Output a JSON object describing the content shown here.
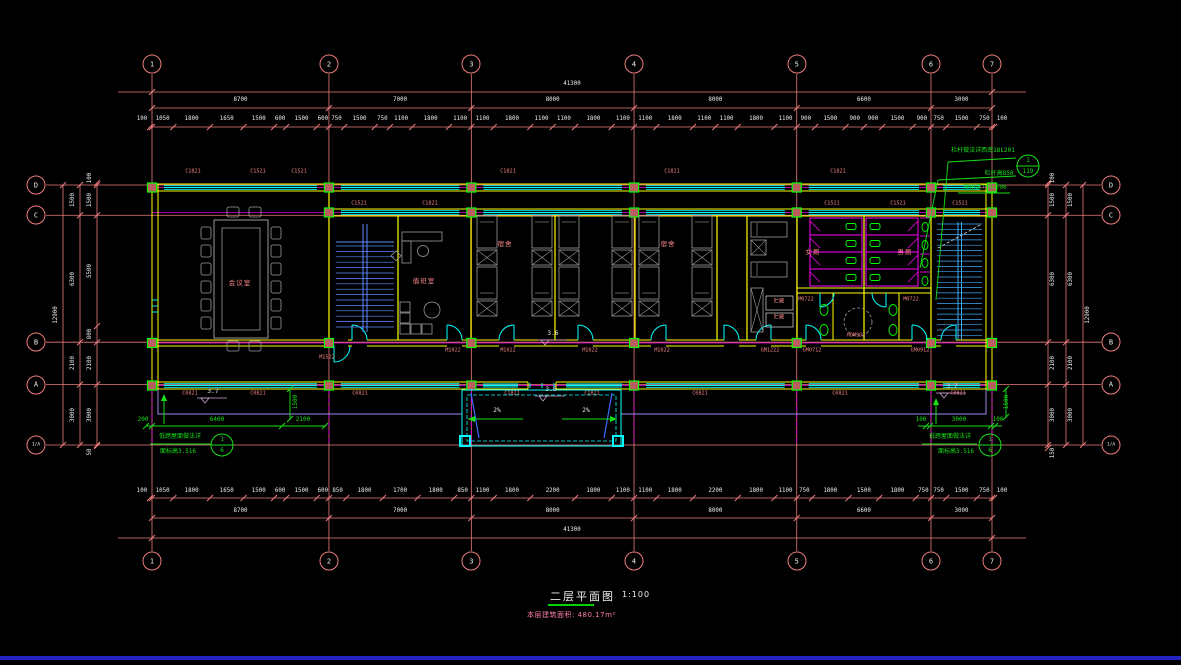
{
  "drawing": {
    "title": "二层平面图",
    "scale": "1:100",
    "area_note": "本层建筑面积: 480.17m²"
  },
  "grid": {
    "cols": [
      {
        "label": "1",
        "mm": 0
      },
      {
        "label": "2",
        "mm": 8700
      },
      {
        "label": "3",
        "mm": 15700
      },
      {
        "label": "4",
        "mm": 23700
      },
      {
        "label": "5",
        "mm": 31700
      },
      {
        "label": "6",
        "mm": 38300
      },
      {
        "label": "7",
        "mm": 41300
      }
    ],
    "rows": [
      {
        "label": "D",
        "mm": 0
      },
      {
        "label": "C",
        "mm": 1500
      },
      {
        "label": "B",
        "mm": 7800
      },
      {
        "label": "A",
        "mm": 9900
      },
      {
        "label": "1/A",
        "mm": 12900
      }
    ]
  },
  "dims": {
    "top": {
      "overall": "41300",
      "spans": [
        "8700",
        "7000",
        "8000",
        "8000",
        "6600",
        "3000"
      ],
      "details": [
        "100",
        "1050",
        "1800",
        "1650",
        "1500",
        "600",
        "1500",
        "600",
        "750",
        "1500",
        "750",
        "1100",
        "1800",
        "1100",
        "1100",
        "1800",
        "1100",
        "1100",
        "1800",
        "1100",
        "1100",
        "1800",
        "1100",
        "1100",
        "1800",
        "1100",
        "900",
        "1500",
        "900",
        "900",
        "1500",
        "900",
        "750",
        "1500",
        "750",
        "100"
      ]
    },
    "bottom": {
      "overall": "41300",
      "spans": [
        "8700",
        "7000",
        "8000",
        "8000",
        "6600",
        "3000"
      ],
      "details": [
        "100",
        "1050",
        "1800",
        "1650",
        "1500",
        "600",
        "1500",
        "600",
        "850",
        "1800",
        "1700",
        "1800",
        "850",
        "1100",
        "1800",
        "2200",
        "1800",
        "1100",
        "1100",
        "1800",
        "2200",
        "1800",
        "1100",
        "750",
        "1800",
        "1500",
        "1800",
        "750",
        "750",
        "1500",
        "750",
        "100"
      ]
    },
    "left": {
      "overall": "12900",
      "spans": [
        "1500",
        "6300",
        "2100",
        "3000"
      ],
      "details": [
        "100",
        "1500",
        "5500",
        "800",
        "2100",
        "3000",
        "50"
      ]
    },
    "right": {
      "overall": "12900",
      "spans": [
        "1500",
        "6300",
        "2100",
        "3000"
      ],
      "details": [
        "100",
        "1500",
        "6300",
        "2100",
        "3000",
        "150"
      ]
    }
  },
  "window_tags": [
    {
      "t": "C1821",
      "x": 193,
      "y": 172
    },
    {
      "t": "C1521",
      "x": 258,
      "y": 172
    },
    {
      "t": "C1521",
      "x": 299,
      "y": 172
    },
    {
      "t": "C1821",
      "x": 508,
      "y": 172
    },
    {
      "t": "C1821",
      "x": 672,
      "y": 172
    },
    {
      "t": "C1821",
      "x": 838,
      "y": 172
    },
    {
      "t": "C1521",
      "x": 359,
      "y": 204
    },
    {
      "t": "C1821",
      "x": 430,
      "y": 204
    },
    {
      "t": "C1521",
      "x": 832,
      "y": 204
    },
    {
      "t": "C1521",
      "x": 898,
      "y": 204
    },
    {
      "t": "C1521",
      "x": 960,
      "y": 204
    },
    {
      "t": "C0821",
      "x": 190,
      "y": 394
    },
    {
      "t": "C0821",
      "x": 258,
      "y": 394
    },
    {
      "t": "C0821",
      "x": 360,
      "y": 394
    },
    {
      "t": "C1821",
      "x": 512,
      "y": 394
    },
    {
      "t": "C1821",
      "x": 592,
      "y": 394
    },
    {
      "t": "C0821",
      "x": 700,
      "y": 394
    },
    {
      "t": "C0821",
      "x": 840,
      "y": 394
    },
    {
      "t": "C0821",
      "x": 958,
      "y": 394
    }
  ],
  "door_tags": [
    {
      "t": "M1022",
      "x": 453,
      "y": 351
    },
    {
      "t": "M1022",
      "x": 508,
      "y": 351
    },
    {
      "t": "M1022",
      "x": 590,
      "y": 351
    },
    {
      "t": "M1022",
      "x": 662,
      "y": 351
    },
    {
      "t": "GM1222",
      "x": 770,
      "y": 351
    },
    {
      "t": "GM0712",
      "x": 812,
      "y": 351
    },
    {
      "t": "GM0912",
      "x": 920,
      "y": 351
    },
    {
      "t": "M0722",
      "x": 806,
      "y": 300
    },
    {
      "t": "M0722",
      "x": 911,
      "y": 300
    },
    {
      "t": "M1522",
      "x": 327,
      "y": 358
    }
  ],
  "room_labels": [
    {
      "t": "会议室",
      "x": 240,
      "y": 283
    },
    {
      "t": "值班室",
      "x": 424,
      "y": 281
    },
    {
      "t": "宿舍",
      "x": 505,
      "y": 244
    },
    {
      "t": "宿舍",
      "x": 668,
      "y": 244
    },
    {
      "t": "女厕",
      "x": 813,
      "y": 252
    },
    {
      "t": "男厕",
      "x": 905,
      "y": 252
    }
  ],
  "small_labels": [
    {
      "t": "HDM902",
      "x": 856,
      "y": 336
    },
    {
      "t": "贮藏",
      "x": 779,
      "y": 302
    },
    {
      "t": "贮藏",
      "x": 779,
      "y": 318
    }
  ],
  "levels": [
    {
      "value": "3.6",
      "x": 553,
      "y": 334
    },
    {
      "value": "3.6",
      "x": 551,
      "y": 390
    },
    {
      "value": "3.7",
      "x": 213,
      "y": 392
    },
    {
      "value": "3.7",
      "x": 952,
      "y": 387
    }
  ],
  "slopes": [
    {
      "label": "2%",
      "x": 497,
      "y": 411,
      "dir": "left",
      "x1": 468,
      "x2": 523,
      "ay": 419
    },
    {
      "label": "2%",
      "x": 586,
      "y": 411,
      "dir": "right",
      "x1": 562,
      "x2": 617,
      "ay": 419
    }
  ],
  "annotations": {
    "top_right": {
      "lines": [
        {
          "t": "栏杆做法详西南18L201",
          "x": 983,
          "y": 151
        },
        {
          "t": "栏杆高850",
          "x": 999,
          "y": 174
        },
        {
          "t": "预留洞700×700",
          "x": 985,
          "y": 188
        }
      ],
      "callout": {
        "top": "1",
        "bottom": "119",
        "cx": 1028,
        "cy": 166
      }
    },
    "bottom_left": {
      "text": "低跨屋面做法详",
      "tx": 180,
      "ty": 437,
      "text2": "面标高3.516",
      "t2x": 178,
      "t2y": 452,
      "callout": {
        "top": "1",
        "bottom": "6",
        "cx": 222,
        "cy": 445
      },
      "dims": [
        {
          "t": "200",
          "x": 143,
          "y": 420
        },
        {
          "t": "6400",
          "x": 217,
          "y": 420
        },
        {
          "t": "2100",
          "x": 303,
          "y": 420
        }
      ],
      "vdim": {
        "t": "1500",
        "x": 296,
        "y": 402
      }
    },
    "bottom_right": {
      "text": "低跨屋面做法详",
      "tx": 950,
      "ty": 437,
      "text2": "面标高3.516",
      "t2x": 956,
      "t2y": 452,
      "callout": {
        "top": "1",
        "bottom": "6",
        "cx": 990,
        "cy": 445
      },
      "dims": [
        {
          "t": "100",
          "x": 921,
          "y": 420
        },
        {
          "t": "3000",
          "x": 959,
          "y": 420
        },
        {
          "t": "100",
          "x": 998,
          "y": 420
        }
      ],
      "vdim": {
        "t": "1500",
        "x": 1007,
        "y": 402
      }
    }
  },
  "colors": {
    "bg": "#000000",
    "grid": "#ED7D7D",
    "dim_text": "#EDEDED",
    "wall": "#FFFF00",
    "window": "#00FFFF",
    "column_stroke": "#00FF00",
    "column_fill": "#BA5F5F",
    "door": "#00FFFF",
    "furniture": "#9A9A9A",
    "stair_left": "#5B8CFF",
    "stair_right": "#3FA9F5",
    "partition": "#FF00FF",
    "fixture": "#00FF00",
    "annotation_green": "#17E117",
    "canopy": "#9D8DF2",
    "axis_magenta": "#FF00FF",
    "tag_pink": "#F08080",
    "note_pink": "#FF7FA8",
    "blue_bar": "#2323BF",
    "level": "#CDA0CD"
  }
}
